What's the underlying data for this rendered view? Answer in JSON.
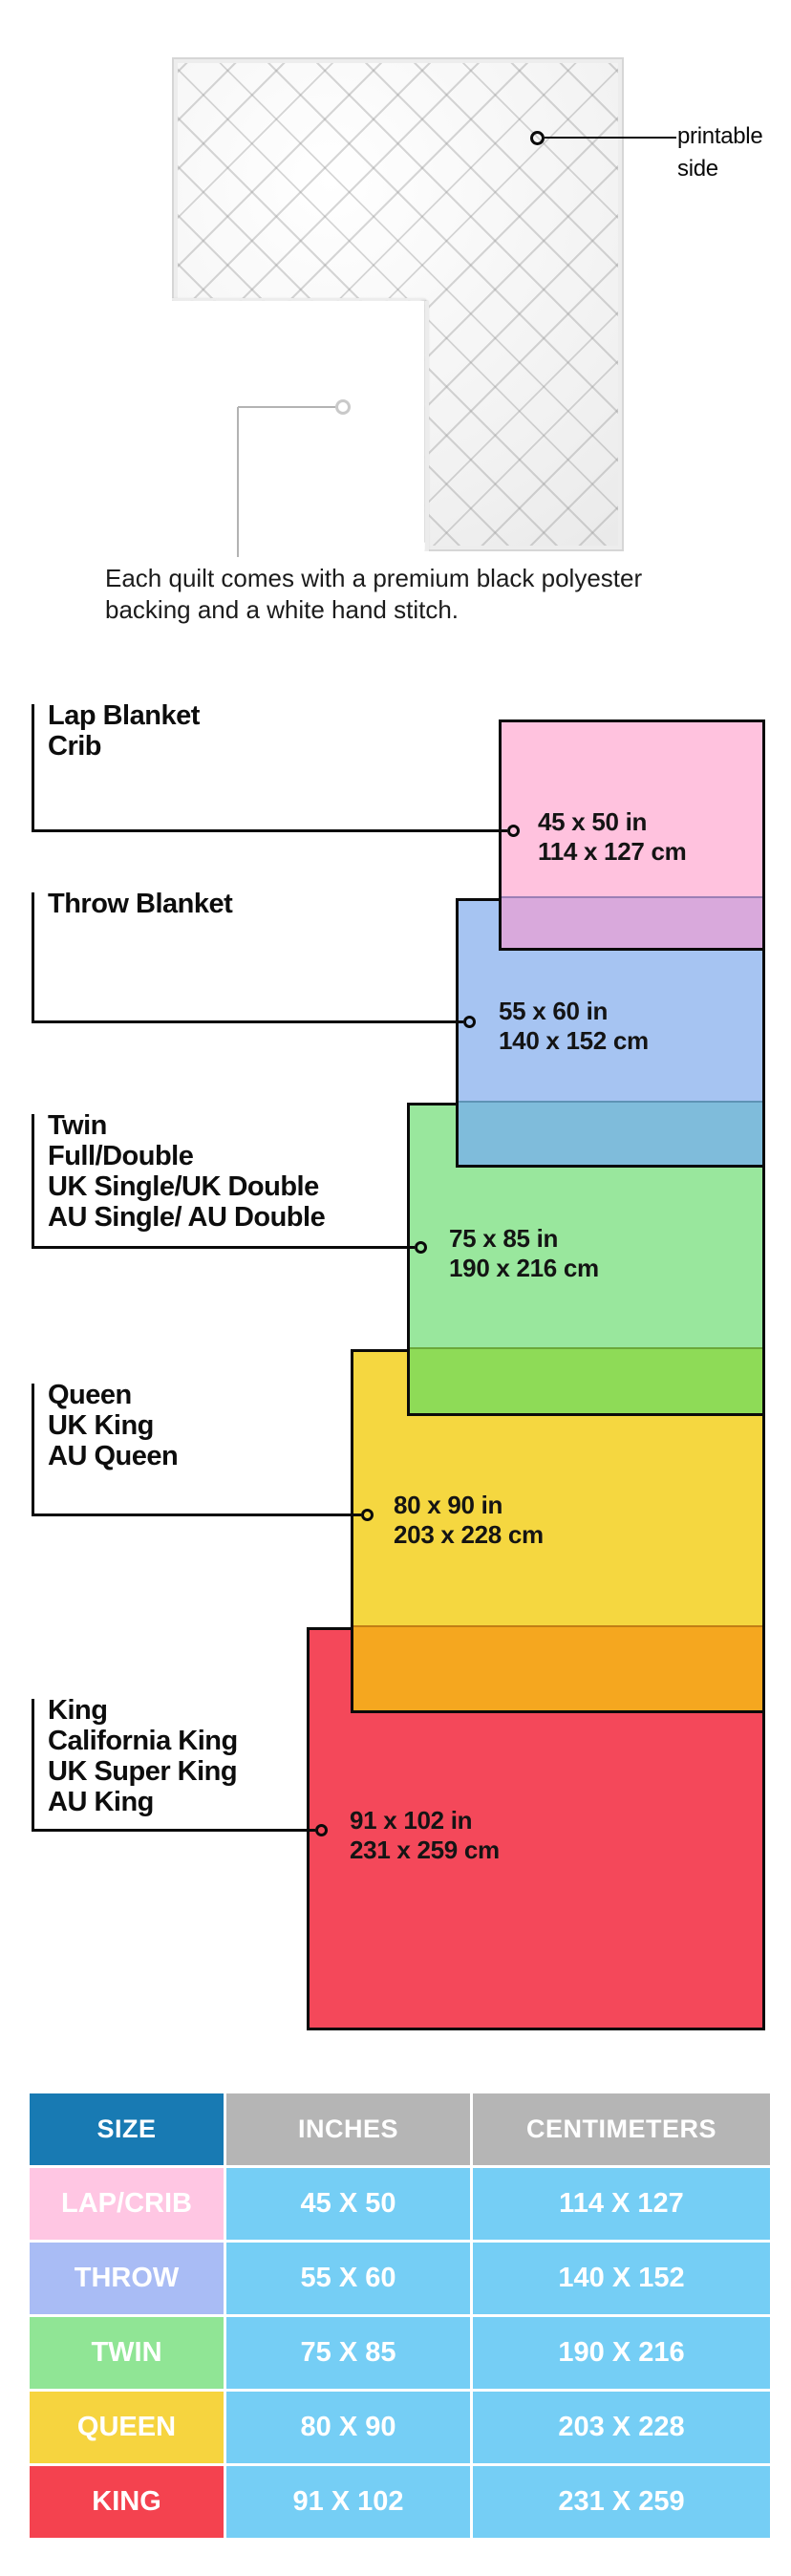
{
  "quilt": {
    "printable_label": [
      "printable",
      "side"
    ],
    "caption_lines": [
      "Each quilt comes with a premium black polyester",
      "backing and a white hand stitch."
    ],
    "top_color": "#ffffff",
    "backing_color": "#141414"
  },
  "diagram": {
    "sizes": [
      {
        "names": [
          "Lap Blanket",
          "Crib"
        ],
        "inches": "45 x 50 in",
        "centimeters": "114 x 127 cm",
        "color": "#FFC2DE",
        "overlap_color": "#D9A9DC"
      },
      {
        "names": [
          "Throw Blanket"
        ],
        "inches": "55 x 60 in",
        "centimeters": "140 x 152 cm",
        "color": "#A6C4F2",
        "overlap_color": "#7FBCDB"
      },
      {
        "names": [
          "Twin",
          "Full/Double",
          "UK Single/UK Double",
          "AU Single/ AU Double"
        ],
        "inches": "75 x 85 in",
        "centimeters": "190 x 216 cm",
        "color": "#99E79D",
        "overlap_color": "#8EDB57"
      },
      {
        "names": [
          "Queen",
          "UK King",
          "AU Queen"
        ],
        "inches": "80 x 90 in",
        "centimeters": "203 x 228 cm",
        "color": "#F5D740",
        "overlap_color": "#F5A71F"
      },
      {
        "names": [
          "King",
          "California King",
          "UK Super King",
          "AU King"
        ],
        "inches": "91 x 102 in",
        "centimeters": "231 x 259 cm",
        "color": "#F4485A",
        "overlap_color": null
      }
    ]
  },
  "table": {
    "headers": [
      "SIZE",
      "INCHES",
      "CENTIMETERS"
    ],
    "header_size_color": "#187AB3",
    "header_other_color": "#B5B5B5",
    "value_cell_color": "#75CEF5",
    "rows": [
      {
        "label": "LAP/CRIB",
        "inches": "45 X 50",
        "centimeters": "114 X 127",
        "label_color": "#FFC6E3"
      },
      {
        "label": "THROW",
        "inches": "55 X 60",
        "centimeters": "140 X 152",
        "label_color": "#A9BCF5"
      },
      {
        "label": "TWIN",
        "inches": "75 X 85",
        "centimeters": "190 X 216",
        "label_color": "#90E595"
      },
      {
        "label": "QUEEN",
        "inches": "80 X 90",
        "centimeters": "203 X 228",
        "label_color": "#F6D43F"
      },
      {
        "label": "KING",
        "inches": "91 X 102",
        "centimeters": "231 X 259",
        "label_color": "#F4424F"
      }
    ]
  }
}
